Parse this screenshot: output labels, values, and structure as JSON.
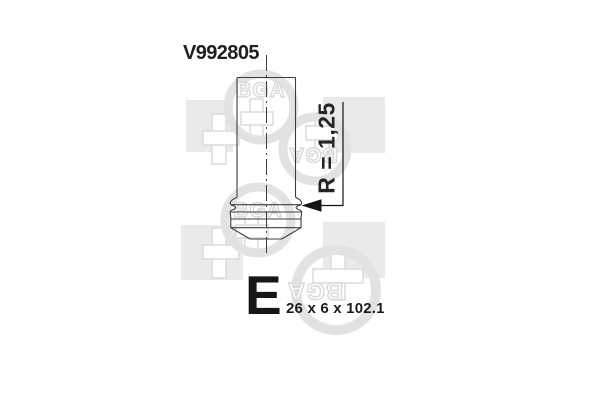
{
  "product": {
    "part_number": "V992805",
    "valve_type_letter": "E",
    "dimensions": "26 x 6 x 102.1",
    "radius_label": "R = 1,25"
  },
  "watermark": {
    "brand": "BGA",
    "square_color": "#eaeaea",
    "outline_color": "#d9d9d9",
    "ring_color": "#e2e2e2"
  },
  "drawing": {
    "line_color": "#3d3d3d",
    "arrow_color": "#141414",
    "kind": "engine valve side view with centerline, fillet radius callout"
  }
}
